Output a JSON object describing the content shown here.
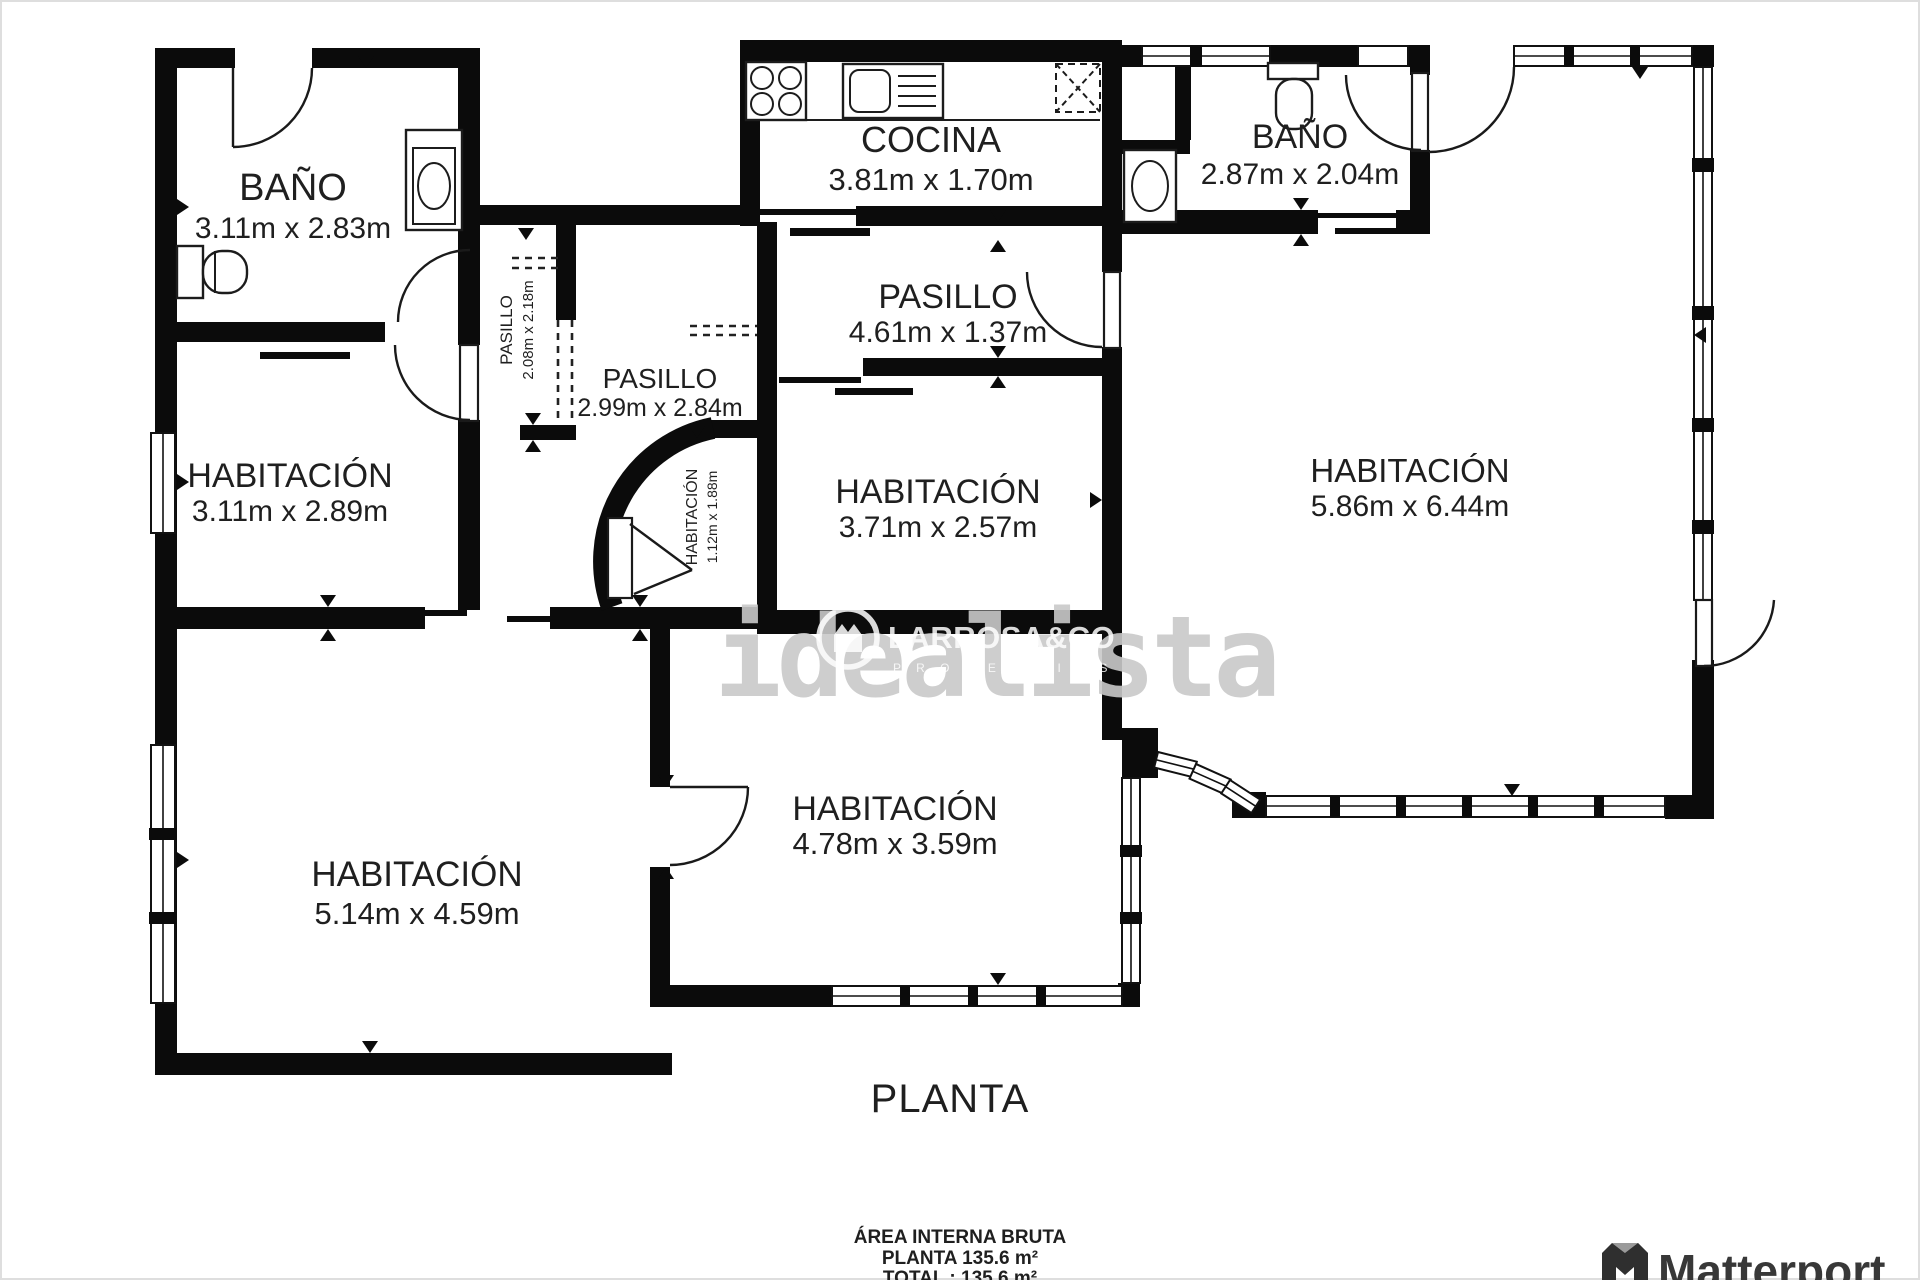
{
  "plan": {
    "title": "PLANTA",
    "rooms": {
      "bano_tl": {
        "name": "BAÑO",
        "dims": "3.11m x 2.83m"
      },
      "cocina": {
        "name": "COCINA",
        "dims": "3.81m x 1.70m"
      },
      "bano_tr": {
        "name": "BAÑO",
        "dims": "2.87m x 2.04m"
      },
      "pasillo_main": {
        "name": "PASILLO",
        "dims": "4.61m x 1.37m"
      },
      "pasillo_small": {
        "name": "PASILLO",
        "dims": "2.08m x 2.18m"
      },
      "pasillo_2": {
        "name": "PASILLO",
        "dims": "2.99m x 2.84m"
      },
      "hab_left": {
        "name": "HABITACIÓN",
        "dims": "3.11m x 2.89m"
      },
      "hab_center": {
        "name": "HABITACIÓN",
        "dims": "3.71m x 2.57m"
      },
      "hab_right": {
        "name": "HABITACIÓN",
        "dims": "5.86m x 6.44m"
      },
      "hab_small": {
        "name": "HABITACIÓN",
        "dims": "1.12m x 1.88m"
      },
      "hab_bottom_left": {
        "name": "HABITACIÓN",
        "dims": "5.14m x 4.59m"
      },
      "hab_bottom_center": {
        "name": "HABITACIÓN",
        "dims": "4.78m x 3.59m"
      }
    },
    "footer": {
      "line1": "ÁREA INTERNA BRUTA",
      "line2": "PLANTA 135.6 m²",
      "line3": "TOTAL :  135.6 m²"
    }
  },
  "watermark": {
    "brand": "idealista",
    "agency": "LARROSA&CO",
    "agency_sub": "P R O P E R T I E S"
  },
  "branding": {
    "matterport": "Matterport"
  },
  "colors": {
    "wall": "#0b0b0b",
    "watermark_gray": "#c9c9c9",
    "watermark_white": "#ffffff",
    "brand_dark": "#383838"
  }
}
